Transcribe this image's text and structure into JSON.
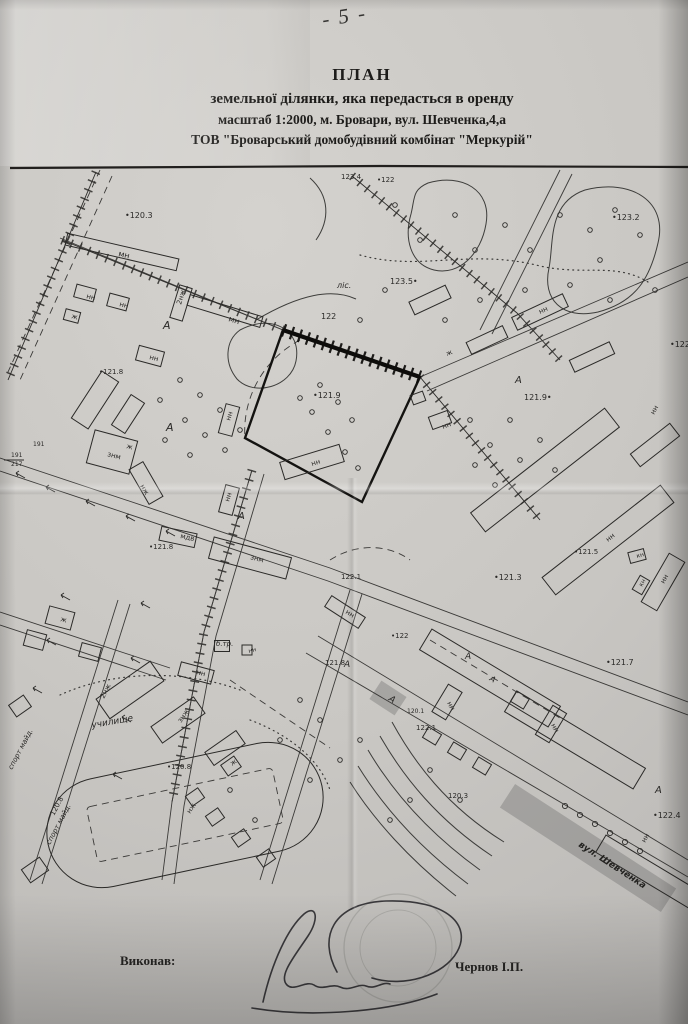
{
  "page": {
    "number": "- 5 -"
  },
  "title": {
    "line1": "ПЛАН",
    "line2": "земельної ділянки, яка передасться в оренду",
    "line3": "масштаб 1:2000, м. Бровари,  вул. Шевченка,4,а",
    "line4": "ТОВ \"Броварський домобудівний комбінат \"Меркурій\""
  },
  "footer": {
    "executed_by_label": "Виконав:",
    "executor_name": "Чернов І.П."
  },
  "map": {
    "paper_color": "#c9c7c3",
    "ink_color": "#2b2a28",
    "marker_highlight_color": "#5e5e5c",
    "street_label": "вул. Шевченка",
    "labels": [
      {
        "t": "•120.3",
        "x": 125,
        "y": 218,
        "s": 8
      },
      {
        "t": "мн",
        "x": 118,
        "y": 256,
        "r": 13,
        "s": 8
      },
      {
        "t": "нн",
        "x": 86,
        "y": 298,
        "r": 15,
        "s": 7
      },
      {
        "t": "нн",
        "x": 119,
        "y": 306,
        "r": 15,
        "s": 7
      },
      {
        "t": "ж",
        "x": 71,
        "y": 318,
        "r": 15,
        "s": 7
      },
      {
        "t": "2нж",
        "x": 181,
        "y": 305,
        "r": -73,
        "s": 7
      },
      {
        "t": "мн",
        "x": 228,
        "y": 321,
        "r": 17,
        "s": 8
      },
      {
        "t": "А",
        "x": 163,
        "y": 329,
        "s": 11,
        "i": 1
      },
      {
        "t": "нн",
        "x": 149,
        "y": 359,
        "r": 15,
        "s": 7
      },
      {
        "t": "ліс.",
        "x": 337,
        "y": 288,
        "s": 8,
        "i": 1
      },
      {
        "t": "123.5•",
        "x": 390,
        "y": 284,
        "s": 8
      },
      {
        "t": "•123.2",
        "x": 612,
        "y": 220,
        "s": 8
      },
      {
        "t": "123.4",
        "x": 341,
        "y": 179,
        "s": 7
      },
      {
        "t": "•122",
        "x": 377,
        "y": 182,
        "s": 7
      },
      {
        "t": "122",
        "x": 321,
        "y": 319,
        "s": 8
      },
      {
        "t": "•121.9",
        "x": 313,
        "y": 398,
        "s": 8
      },
      {
        "t": "нн",
        "x": 312,
        "y": 466,
        "r": -17,
        "s": 7
      },
      {
        "t": "А",
        "x": 515,
        "y": 383,
        "s": 10,
        "i": 1
      },
      {
        "t": "ж",
        "x": 447,
        "y": 356,
        "r": -20,
        "s": 7
      },
      {
        "t": "нн",
        "x": 443,
        "y": 429,
        "r": -20,
        "s": 7
      },
      {
        "t": "121.9•",
        "x": 524,
        "y": 400,
        "s": 8
      },
      {
        "t": "•122.1",
        "x": 670,
        "y": 347,
        "s": 8
      },
      {
        "t": "нн",
        "x": 654,
        "y": 415,
        "r": -60,
        "s": 7
      },
      {
        "t": "нн",
        "x": 540,
        "y": 314,
        "r": -25,
        "s": 7
      },
      {
        "t": "•121.8",
        "x": 99,
        "y": 374,
        "s": 7
      },
      {
        "t": "знм",
        "x": 107,
        "y": 456,
        "r": 15,
        "s": 7
      },
      {
        "t": "191",
        "x": 33,
        "y": 446,
        "s": 6
      },
      {
        "t": "191",
        "x": 11,
        "y": 457,
        "s": 6
      },
      {
        "t": "217",
        "x": 11,
        "y": 466,
        "s": 6
      },
      {
        "t": "ж",
        "x": 126,
        "y": 448,
        "r": 15,
        "s": 7
      },
      {
        "t": "нж",
        "x": 140,
        "y": 486,
        "r": 60,
        "s": 7
      },
      {
        "t": "А",
        "x": 166,
        "y": 431,
        "s": 11,
        "i": 1
      },
      {
        "t": "нн",
        "x": 230,
        "y": 421,
        "r": -73,
        "s": 7
      },
      {
        "t": "мдв",
        "x": 180,
        "y": 538,
        "r": 12,
        "s": 7
      },
      {
        "t": "•121.8",
        "x": 149,
        "y": 549,
        "s": 7
      },
      {
        "t": "знм",
        "x": 250,
        "y": 559,
        "r": 15,
        "s": 7
      },
      {
        "t": "нн",
        "x": 229,
        "y": 502,
        "r": -73,
        "s": 7
      },
      {
        "t": "А",
        "x": 238,
        "y": 519,
        "s": 10,
        "i": 1
      },
      {
        "t": "122.1",
        "x": 341,
        "y": 579,
        "s": 7
      },
      {
        "t": "•121.3",
        "x": 494,
        "y": 580,
        "s": 8
      },
      {
        "t": "•121.7",
        "x": 606,
        "y": 665,
        "s": 8
      },
      {
        "t": "б.тр.",
        "x": 216,
        "y": 646,
        "s": 7,
        "i": 1
      },
      {
        "t": "нн",
        "x": 249,
        "y": 653,
        "r": -15,
        "s": 6
      },
      {
        "t": "нн",
        "x": 196,
        "y": 674,
        "r": 15,
        "s": 7
      },
      {
        "t": "121.8",
        "x": 325,
        "y": 665,
        "s": 7
      },
      {
        "t": "А",
        "x": 344,
        "y": 667,
        "s": 9,
        "i": 1
      },
      {
        "t": "•122",
        "x": 391,
        "y": 638,
        "s": 7
      },
      {
        "t": "122.1",
        "x": 416,
        "y": 730,
        "s": 7
      },
      {
        "t": "120.1",
        "x": 407,
        "y": 713,
        "s": 6
      },
      {
        "t": "120.3",
        "x": 448,
        "y": 798,
        "s": 7
      },
      {
        "t": "нн",
        "x": 447,
        "y": 703,
        "r": 62,
        "s": 7
      },
      {
        "t": "нн",
        "x": 551,
        "y": 725,
        "r": 62,
        "s": 7
      },
      {
        "t": "нн",
        "x": 345,
        "y": 613,
        "r": 33,
        "s": 7
      },
      {
        "t": "училище",
        "x": 92,
        "y": 728,
        "r": -10,
        "s": 9,
        "i": 1
      },
      {
        "t": "2нж",
        "x": 104,
        "y": 699,
        "r": -63,
        "s": 7
      },
      {
        "t": "знж",
        "x": 181,
        "y": 723,
        "r": -55,
        "s": 7
      },
      {
        "t": "нж",
        "x": 190,
        "y": 814,
        "r": -55,
        "s": 7
      },
      {
        "t": "ж",
        "x": 232,
        "y": 766,
        "r": -35,
        "s": 7
      },
      {
        "t": "•120.8",
        "x": 167,
        "y": 769,
        "s": 7
      },
      {
        "t": "120.8",
        "x": 54,
        "y": 816,
        "r": -62,
        "s": 7
      },
      {
        "t": "спорт майд.",
        "x": 50,
        "y": 845,
        "r": -62,
        "s": 7,
        "i": 1
      },
      {
        "t": "спорт майд.",
        "x": 12,
        "y": 770,
        "r": -62,
        "s": 7,
        "i": 1
      },
      {
        "t": "вул. Шевченка",
        "x": 578,
        "y": 846,
        "r": 33,
        "s": 9,
        "i": 1,
        "hl": 1
      },
      {
        "t": "•122.4",
        "x": 653,
        "y": 818,
        "s": 8
      },
      {
        "t": "нн",
        "x": 645,
        "y": 843,
        "r": -60,
        "s": 7
      },
      {
        "t": "А",
        "x": 655,
        "y": 793,
        "s": 10,
        "i": 1
      },
      {
        "t": "А",
        "x": 465,
        "y": 659,
        "s": 9,
        "i": 1
      },
      {
        "t": "нн",
        "x": 608,
        "y": 542,
        "r": -38,
        "s": 7
      },
      {
        "t": "нн",
        "x": 664,
        "y": 584,
        "r": -60,
        "s": 7
      },
      {
        "t": "•121.5",
        "x": 574,
        "y": 554,
        "s": 7
      },
      {
        "t": "кн",
        "x": 637,
        "y": 558,
        "r": -15,
        "s": 6
      },
      {
        "t": "кн",
        "x": 642,
        "y": 587,
        "r": -60,
        "s": 6
      },
      {
        "t": "ж",
        "x": 60,
        "y": 621,
        "r": 15,
        "s": 7
      },
      {
        "t": "А",
        "x": 489,
        "y": 680,
        "r": 31,
        "s": 8,
        "i": 1
      },
      {
        "t": "А",
        "x": 388,
        "y": 700,
        "r": 33,
        "s": 9,
        "i": 1
      }
    ]
  }
}
